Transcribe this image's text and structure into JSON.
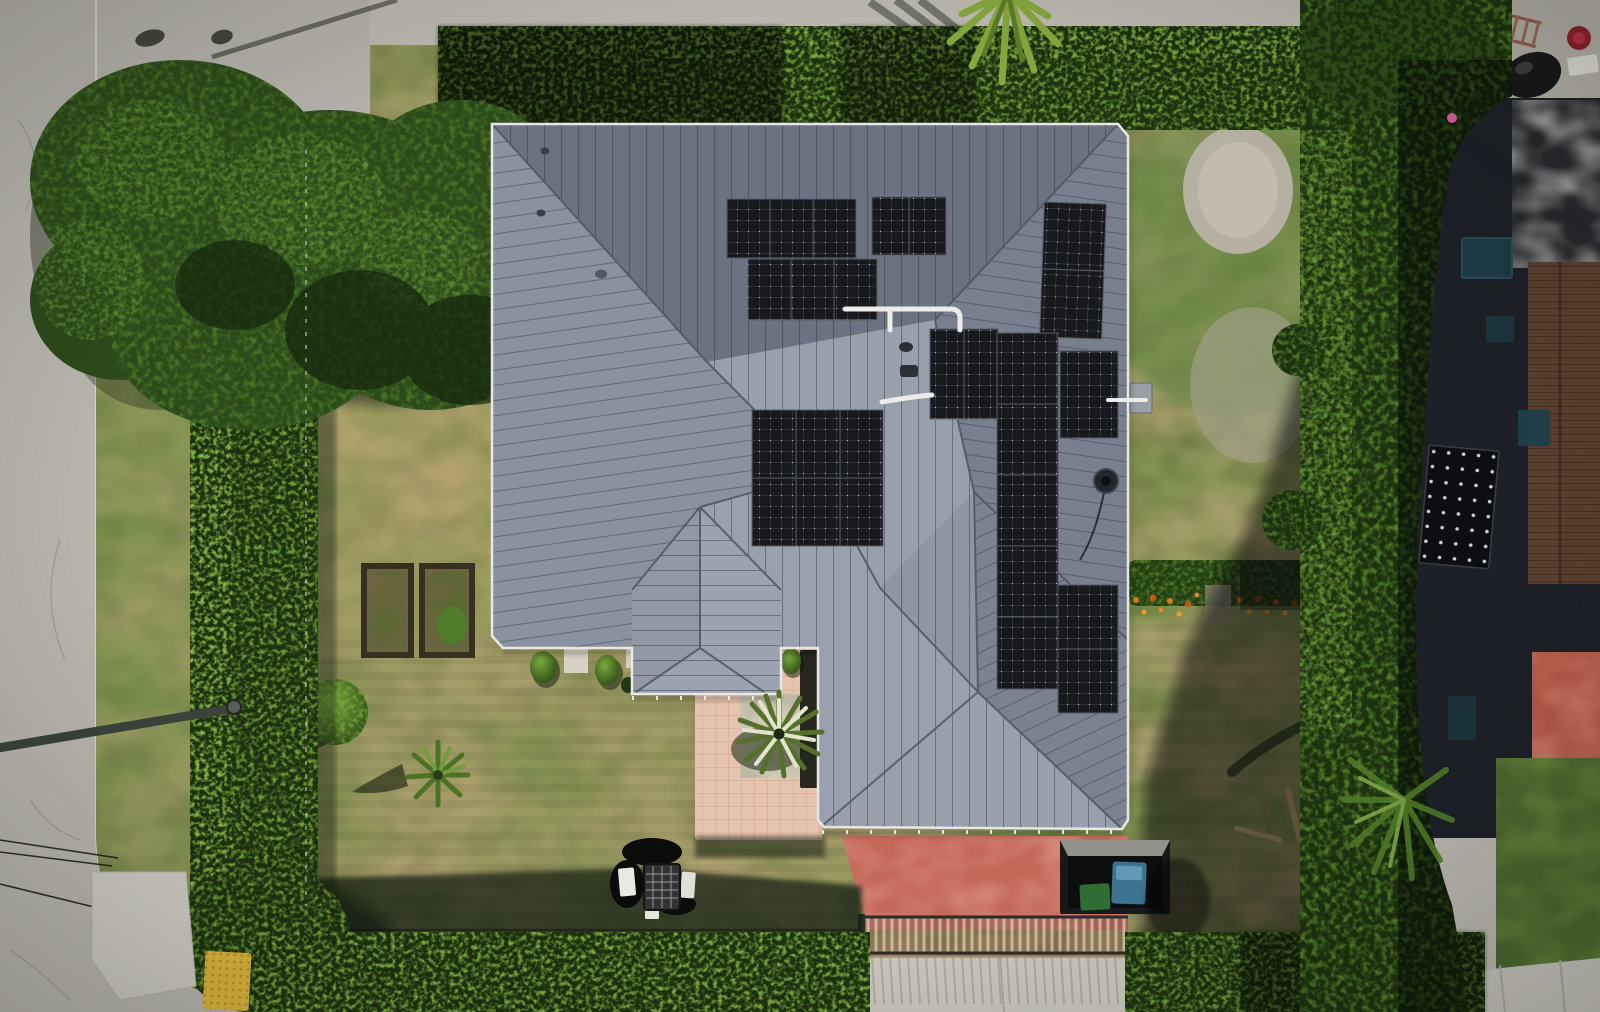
{
  "scene": {
    "type": "aerial-drone-photo",
    "description": "Top-down aerial view of a suburban house with a gray standing-seam metal hip roof fitted with black solar panel arrays, patchy green-tan lawn, perimeter hedges, a street on the left, a pink paver walkway with a yucca plant, a red driveway with a metal gate, and a neighboring house on the right",
    "objects": [
      "street",
      "grass verge",
      "perimeter hedge",
      "shade tree",
      "metal hip roof",
      "solar panel arrays",
      "porch roof",
      "paver walkway",
      "yucca plant",
      "garden beds",
      "round shrub",
      "small palm",
      "patio table set",
      "storage shed",
      "red driveway",
      "driveway gate",
      "concrete apron",
      "utility pole",
      "power lines",
      "curb ramp",
      "tactile paving mat",
      "flower border",
      "dirt patch",
      "neighbor house",
      "neighbor brown roof",
      "neighbor flat roof",
      "neighbor solar panel",
      "ladder",
      "palm fronds"
    ]
  },
  "solar": {
    "arrays": [
      {
        "name": "north-upper-left",
        "modules": 3
      },
      {
        "name": "north-upper-right",
        "modules": 2
      },
      {
        "name": "north-lower",
        "modules": 3
      },
      {
        "name": "east-ridge-pair",
        "modules": 2
      },
      {
        "name": "center-grid",
        "modules": 6
      },
      {
        "name": "east-cluster-left",
        "modules": 2
      },
      {
        "name": "east-strip",
        "modules": 5
      },
      {
        "name": "east-cluster-right",
        "modules": 1
      },
      {
        "name": "wing-pair",
        "modules": 2
      }
    ],
    "total_modules": 26,
    "panel_color": "#16181c"
  },
  "colors": {
    "road": "#b6b4ac",
    "street_top": "#bdbab1",
    "lawn_base": "#ab9f6e",
    "lawn_green": "#6e8d43",
    "hedge_dark": "#1c3110",
    "hedge_light": "#79a83a",
    "tree": "#2c4a1b",
    "roof_top": "#6b7383",
    "roof_left": "#8a91a0",
    "roof_right": "#78808f",
    "roof_center_upper": "#99a0ad",
    "roof_center": "#9aa1ae",
    "roof_wing_gable": "#8e95a4",
    "roof_wing_right": "#7b8391",
    "roof_wing_bottom": "#99a0ac",
    "porch": "#9ca3b0",
    "walkway": "#e6c3ae",
    "gravel": "#d3cdbc",
    "driveway_red": "#c4685a",
    "apron": "#c6c4bb",
    "shed_roof": "#18191b",
    "neighbor_house": "#1d2127",
    "neighbor_roof_brown": "#59402f",
    "neighbor_wall_red": "#b25747",
    "dirt": "#b5b0a2",
    "flower_orange": "#e07818",
    "mat_yellow": "#d8b23c",
    "panel": "#16181c",
    "conduit": "#ececea",
    "gutter": "#e7e7e3"
  }
}
